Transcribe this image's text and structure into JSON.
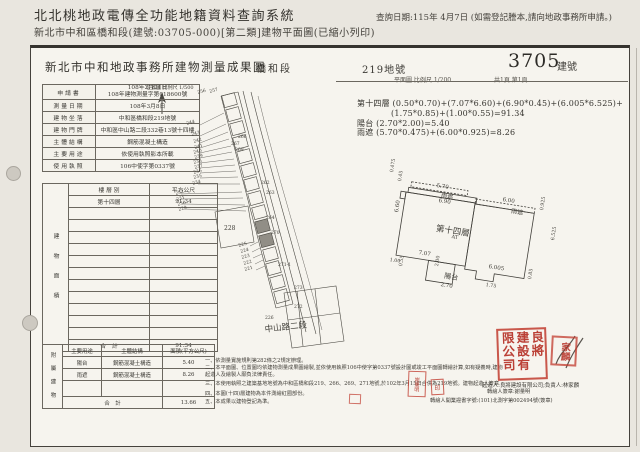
{
  "app_header": {
    "title": "北北桃地政電傳全功能地籍資料查詢系統",
    "subtitle": "新北市中和區橋和段(建號:03705-000)[第二類]建物平面圖(已縮小列印)",
    "query_date": "查詢日期:115年 4月7日 (如需登記謄本,請向地政事務所申請。)"
  },
  "doc_header": {
    "office_title": "新北市中和地政事務所建物測量成果圖",
    "section": "橋和段",
    "land_no": "219地號",
    "building_no": "3705",
    "building_no_suffix": "建號",
    "scale_note": "平面圖 比例尺 1/200",
    "page_note": "共1頁 第1頁"
  },
  "info_table": {
    "rows": [
      {
        "label": "申請書",
        "value": "108年2月21日",
        "value2": "108年建物測量字第018600號"
      },
      {
        "label": "測量日期",
        "value": "108年3月8日"
      },
      {
        "label": "建物坐落",
        "value": "中和區橋和段219地號"
      },
      {
        "label": "建物門牌",
        "value": "中和區中山路二段332巷13號十四樓"
      },
      {
        "label": "主體結構",
        "value": "鋼筋混凝土構造"
      },
      {
        "label": "主要用途",
        "value": "依使用執照影本所載"
      },
      {
        "label": "使用執照",
        "value": "106中使字第0337號"
      }
    ]
  },
  "area_table": {
    "side_label": "建物面積",
    "headers": [
      "樓 層 別",
      "平方公尺"
    ],
    "floor": "第十四層",
    "floor_area": "91.34",
    "total_label": "合　計",
    "total": "91.34"
  },
  "annex_table": {
    "side_label": "附屬建物",
    "headers": [
      "主要用途",
      "主體結構",
      "面積(平方公尺)"
    ],
    "rows": [
      {
        "use": "陽台",
        "struct": "鋼筋混凝土構造",
        "area": "5.40"
      },
      {
        "use": "雨遮",
        "struct": "鋼筋混凝土構造",
        "area": "8.26"
      }
    ],
    "total_label": "合　計",
    "total": "13.66"
  },
  "formulas": {
    "line1": "第十四層 (0.50*0.70)+(7.07*6.60)+(6.90*0.45)+(6.005*6.525)+",
    "line2": "(1.75*0.85)+(1.00*0.55)=91.34",
    "line3": "陽台 (2.70*2.00)=5.40",
    "line4": "雨遮 (5.70*0.475)+(6.00*0.925)=8.26"
  },
  "notes": [
    "一、依測量實施規則第282條之2規定辦理。",
    "二、本平面圖、位置圖均依建物測量成果圖繪製,並依使用執照106中使字第0337號設計圖或竣工平面圖轉繪計算,如有疑義時,建物起造人及繪製人願負法律責任。",
    "三、本使用執照之建築基地地號為中和區橋和段219、266、269、271地號,於102年3月15日合併為219地號。建物起造人簽章",
    "四、本圖(十四)層建物為本件測繪紅圈部份。",
    "五、本成果以建物登記為準。"
  ],
  "signatures": {
    "transcriber": "轉繪人簽章:謝量明",
    "license": "轉繪人開業證書字號:(101)北測字第002494號(簽章)",
    "builder": "起造人:良將建設有限公司;負責人:林家麟"
  },
  "stamps": {
    "company": [
      "良將",
      "建設有",
      "限公司"
    ],
    "person": "家麟",
    "note_seal": "謝量明",
    "small_seal": "印"
  },
  "colors": {
    "paper": "#f6f4ee",
    "background": "#e9e6df",
    "ink": "#3c3a35",
    "stamp_red": "#c13b2e"
  },
  "labels": [
    {
      "t": "位置圖 比例尺 1/500",
      "x": 146,
      "y": 84,
      "s": 5,
      "n": "location-scale-note"
    },
    {
      "t": "256",
      "x": 197,
      "y": 91,
      "s": 4.5,
      "r": -15,
      "n": "parcel-label"
    },
    {
      "t": "257",
      "x": 209,
      "y": 90,
      "s": 4.5,
      "r": -15,
      "n": "parcel-label"
    },
    {
      "t": "244",
      "x": 186,
      "y": 122,
      "s": 4.5,
      "r": -15,
      "n": "parcel-label"
    },
    {
      "t": "243",
      "x": 191,
      "y": 133,
      "s": 4.5,
      "r": -15,
      "n": "parcel-label"
    },
    {
      "t": "242",
      "x": 193,
      "y": 140,
      "s": 4.5,
      "r": -15,
      "n": "parcel-label"
    },
    {
      "t": "241",
      "x": 194,
      "y": 146,
      "s": 4.5,
      "r": -15,
      "n": "parcel-label"
    },
    {
      "t": "240",
      "x": 193,
      "y": 151,
      "s": 4.5,
      "r": -15,
      "n": "parcel-label"
    },
    {
      "t": "239",
      "x": 194,
      "y": 156,
      "s": 4.5,
      "r": -15,
      "n": "parcel-label"
    },
    {
      "t": "238",
      "x": 193,
      "y": 161,
      "s": 4.5,
      "r": -15,
      "n": "parcel-label"
    },
    {
      "t": "237",
      "x": 194,
      "y": 166,
      "s": 4.5,
      "r": -15,
      "n": "parcel-label"
    },
    {
      "t": "236",
      "x": 193,
      "y": 171,
      "s": 4.5,
      "r": -15,
      "n": "parcel-label"
    },
    {
      "t": "235",
      "x": 193,
      "y": 176,
      "s": 4.5,
      "r": -15,
      "n": "parcel-label"
    },
    {
      "t": "234",
      "x": 192,
      "y": 182,
      "s": 4.5,
      "r": -15,
      "n": "parcel-label"
    },
    {
      "t": "232",
      "x": 175,
      "y": 192,
      "s": 4.5,
      "r": -15,
      "n": "parcel-label"
    },
    {
      "t": "231",
      "x": 176,
      "y": 198,
      "s": 4.5,
      "r": -15,
      "n": "parcel-label"
    },
    {
      "t": "230",
      "x": 177,
      "y": 203,
      "s": 4.5,
      "r": -15,
      "n": "parcel-label"
    },
    {
      "t": "229",
      "x": 178,
      "y": 208,
      "s": 4.5,
      "r": -15,
      "n": "parcel-label"
    },
    {
      "t": "266",
      "x": 238,
      "y": 135,
      "s": 4.5,
      "n": "parcel-label"
    },
    {
      "t": "267",
      "x": 231,
      "y": 142,
      "s": 4.5,
      "n": "parcel-label"
    },
    {
      "t": "269",
      "x": 235,
      "y": 148,
      "s": 4.5,
      "n": "parcel-label"
    },
    {
      "t": "262",
      "x": 261,
      "y": 181,
      "s": 4.5,
      "n": "parcel-label"
    },
    {
      "t": "263",
      "x": 266,
      "y": 191,
      "s": 4.5,
      "n": "parcel-label"
    },
    {
      "t": "264",
      "x": 266,
      "y": 216,
      "s": 4.5,
      "n": "parcel-label"
    },
    {
      "t": "270",
      "x": 271,
      "y": 231,
      "s": 4.5,
      "n": "parcel-label"
    },
    {
      "t": "271-1",
      "x": 278,
      "y": 263,
      "s": 4.5,
      "n": "parcel-label"
    },
    {
      "t": "273",
      "x": 294,
      "y": 286,
      "s": 4.5,
      "n": "parcel-label"
    },
    {
      "t": "272",
      "x": 294,
      "y": 305,
      "s": 4.5,
      "n": "parcel-label"
    },
    {
      "t": "226",
      "x": 265,
      "y": 316,
      "s": 4.5,
      "n": "parcel-label"
    },
    {
      "t": "228",
      "x": 224,
      "y": 225,
      "s": 6,
      "n": "parcel-label"
    },
    {
      "t": "225",
      "x": 238,
      "y": 244,
      "s": 4.5,
      "r": -15,
      "n": "parcel-label"
    },
    {
      "t": "224",
      "x": 240,
      "y": 250,
      "s": 4.5,
      "r": -15,
      "n": "parcel-label"
    },
    {
      "t": "223",
      "x": 241,
      "y": 256,
      "s": 4.5,
      "r": -15,
      "n": "parcel-label"
    },
    {
      "t": "222",
      "x": 243,
      "y": 262,
      "s": 4.5,
      "r": -15,
      "n": "parcel-label"
    },
    {
      "t": "221",
      "x": 244,
      "y": 268,
      "s": 4.5,
      "r": -15,
      "n": "parcel-label"
    },
    {
      "t": "中山路二段",
      "x": 264,
      "y": 323,
      "s": 8.5,
      "r": -6,
      "n": "road-label"
    },
    {
      "t": "5.70",
      "x": 437,
      "y": 183,
      "s": 5.5,
      "r": 9,
      "n": "dim-label"
    },
    {
      "t": "雨遮",
      "x": 442,
      "y": 190,
      "s": 6,
      "r": 9,
      "n": "canopy-label"
    },
    {
      "t": "6.90",
      "x": 439,
      "y": 198,
      "s": 5.5,
      "r": 9,
      "n": "dim-label"
    },
    {
      "t": "6.00",
      "x": 503,
      "y": 197,
      "s": 5.5,
      "r": 9,
      "n": "dim-label"
    },
    {
      "t": "雨遮",
      "x": 512,
      "y": 206,
      "s": 6,
      "r": 9,
      "n": "canopy-label"
    },
    {
      "t": "0.925",
      "x": 540,
      "y": 210,
      "s": 4.8,
      "r": -81,
      "n": "dim-label"
    },
    {
      "t": "0.475",
      "x": 390,
      "y": 172,
      "s": 4.8,
      "r": -81,
      "n": "dim-label"
    },
    {
      "t": "0.45",
      "x": 398,
      "y": 181,
      "s": 4.8,
      "r": -81,
      "n": "dim-label"
    },
    {
      "t": "6.60",
      "x": 394,
      "y": 212,
      "s": 5.5,
      "r": -81,
      "n": "dim-label"
    },
    {
      "t": "第十四層",
      "x": 437,
      "y": 222,
      "s": 8.5,
      "r": 9,
      "n": "floor-label"
    },
    {
      "t": "AT",
      "x": 452,
      "y": 234,
      "s": 5,
      "r": 9,
      "n": "plan-annotation"
    },
    {
      "t": "6.525",
      "x": 551,
      "y": 240,
      "s": 4.8,
      "r": -81,
      "n": "dim-label"
    },
    {
      "t": "7.07",
      "x": 419,
      "y": 250,
      "s": 5.5,
      "r": 9,
      "n": "dim-label"
    },
    {
      "t": "1.00",
      "x": 390,
      "y": 258,
      "s": 4.8,
      "r": 9,
      "n": "dim-label"
    },
    {
      "t": "0.55",
      "x": 399,
      "y": 266,
      "s": 4.8,
      "r": -81,
      "n": "dim-label"
    },
    {
      "t": "2.00",
      "x": 435,
      "y": 266,
      "s": 4.8,
      "r": -81,
      "n": "dim-label"
    },
    {
      "t": "陽台",
      "x": 445,
      "y": 271,
      "s": 7,
      "r": 9,
      "n": "balcony-label"
    },
    {
      "t": "6.005",
      "x": 489,
      "y": 264,
      "s": 5.5,
      "r": 9,
      "n": "dim-label"
    },
    {
      "t": "2.70",
      "x": 441,
      "y": 282,
      "s": 5.5,
      "r": 9,
      "n": "dim-label"
    },
    {
      "t": "1.75",
      "x": 486,
      "y": 283,
      "s": 4.8,
      "r": 9,
      "n": "dim-label"
    },
    {
      "t": "0.85",
      "x": 528,
      "y": 279,
      "s": 4.8,
      "r": -81,
      "n": "dim-label"
    }
  ]
}
